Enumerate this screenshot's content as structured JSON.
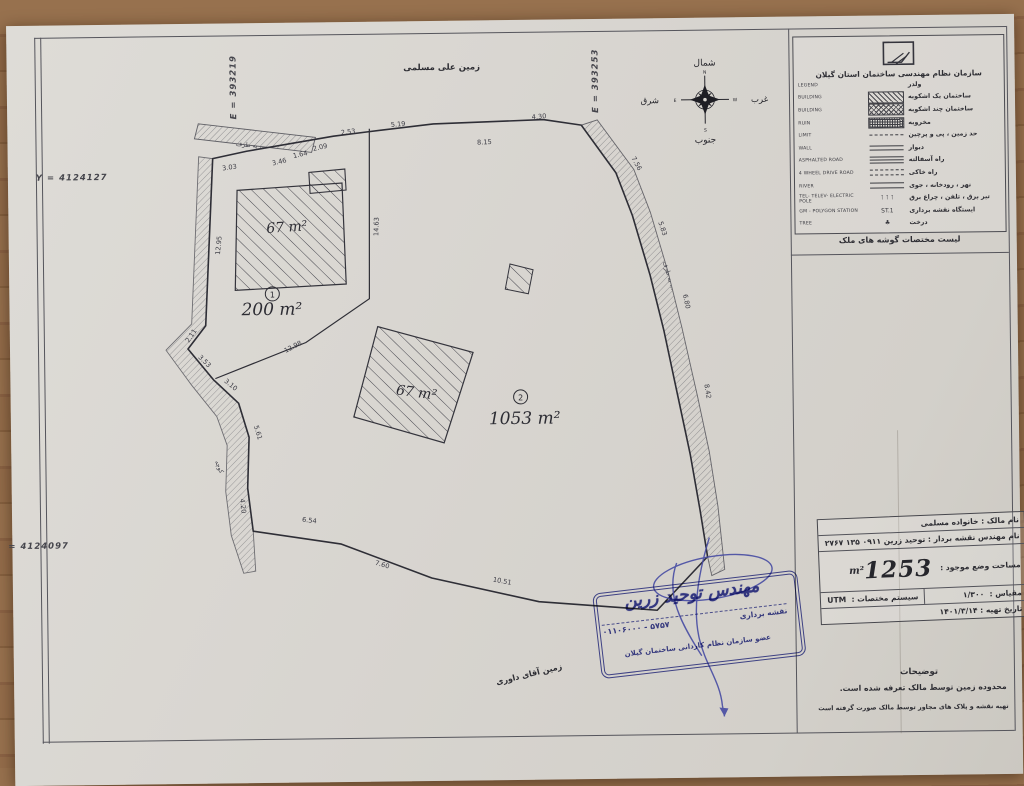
{
  "colors": {
    "paper": "#d8d5d0",
    "ink": "#3b3b44",
    "stamp_blue": "#41469d",
    "wood": "#8d6847"
  },
  "coordinates": {
    "y_top": "Y = 4124127",
    "y_bottom": "= 4124097",
    "e_left": "E = 393219",
    "e_right": "E = 393253"
  },
  "top_label": "زمین علی مسلمی",
  "bottom_left_label": "زمین آقای داوری",
  "compass": {
    "north_fa": "شمال",
    "south_fa": "جنوب",
    "east_fa": "شرق",
    "west_fa": "غرب",
    "n": "N",
    "s": "S",
    "e": "E",
    "w": "W"
  },
  "parcels": {
    "p1": {
      "number": "1",
      "area": "200",
      "area_unit": "m²",
      "building_area": "67",
      "building_unit": "m²"
    },
    "p2": {
      "number": "2",
      "area": "1053",
      "area_unit": "m²",
      "building_area": "67",
      "building_unit": "m²"
    }
  },
  "measurements": [
    {
      "v": "3.03",
      "x": 222,
      "y": 146,
      "r": -8
    },
    {
      "v": "3.46",
      "x": 272,
      "y": 141,
      "r": -12
    },
    {
      "v": "1.64",
      "x": 293,
      "y": 134,
      "r": -12
    },
    {
      "v": "2.09",
      "x": 313,
      "y": 127,
      "r": -12
    },
    {
      "v": "2.53",
      "x": 341,
      "y": 112,
      "r": -6
    },
    {
      "v": "5.19",
      "x": 391,
      "y": 105,
      "r": -4
    },
    {
      "v": "8.15",
      "x": 477,
      "y": 124,
      "r": -2
    },
    {
      "v": "4.30",
      "x": 532,
      "y": 99,
      "r": -4
    },
    {
      "v": "12.95",
      "x": 212,
      "y": 222,
      "r": -84
    },
    {
      "v": "14.63",
      "x": 370,
      "y": 205,
      "r": -88
    },
    {
      "v": "12.98",
      "x": 284,
      "y": 326,
      "r": -27
    },
    {
      "v": "2.11",
      "x": 183,
      "y": 313,
      "r": -55
    },
    {
      "v": "3.53",
      "x": 193,
      "y": 339,
      "r": 45
    },
    {
      "v": "3.10",
      "x": 219,
      "y": 363,
      "r": 40
    },
    {
      "v": "5.61",
      "x": 245,
      "y": 410,
      "r": 74
    },
    {
      "v": "4.20",
      "x": 229,
      "y": 483,
      "r": 84
    },
    {
      "v": "6.54",
      "x": 297,
      "y": 500,
      "r": 7
    },
    {
      "v": "7.60",
      "x": 369,
      "y": 545,
      "r": 16
    },
    {
      "v": "10.51",
      "x": 489,
      "y": 563,
      "r": 11
    },
    {
      "v": "7.56",
      "x": 627,
      "y": 146,
      "r": 62
    },
    {
      "v": "5.83",
      "x": 652,
      "y": 211,
      "r": 72
    },
    {
      "v": "6.80",
      "x": 675,
      "y": 284,
      "r": 78
    },
    {
      "v": "8.42",
      "x": 695,
      "y": 374,
      "r": 81
    }
  ],
  "road_labels": [
    {
      "t": "به طرف ...",
      "x": 243,
      "y": 124,
      "r": 6
    },
    {
      "t": "به طرف ...",
      "x": 658,
      "y": 258,
      "r": 74
    },
    {
      "t": "کوچه",
      "x": 206,
      "y": 444,
      "r": 68
    }
  ],
  "legend": {
    "org_name": "سازمان نظام مهندسی ساختمان استان گیلان",
    "footer": "لیست مختصات گوشه های ملک",
    "rows": [
      {
        "en": "LEGEND",
        "fa": "ولدر",
        "sym": "none"
      },
      {
        "en": "BUILDING",
        "fa": "ساختمان یک اشکوبه",
        "sym": "diagonal-hatch"
      },
      {
        "en": "BUILDING",
        "fa": "ساختمان چند اشکوبه",
        "sym": "cross-hatch"
      },
      {
        "en": "RUIN",
        "fa": "مخروبه",
        "sym": "dense-hatch"
      },
      {
        "en": "LIMIT",
        "fa": "حد زمین ، پی و پرچین",
        "sym": "dash-dot"
      },
      {
        "en": "WALL",
        "fa": "دیوار",
        "sym": "double-line"
      },
      {
        "en": "ASPHALTED ROAD",
        "fa": "راه آسفالته",
        "sym": "triple-line"
      },
      {
        "en": "4 WHEEL DRIVE ROAD",
        "fa": "راه خاکی",
        "sym": "dashed-lines"
      },
      {
        "en": "RIVER",
        "fa": "نهر ، رودخانه ، جوی",
        "sym": "river-lines"
      },
      {
        "en": "TEL- TELEV- ELECTRIC POLE",
        "fa": "تیر برق ، تلفن ، چراغ برق",
        "sym": "poles"
      },
      {
        "en": "GM - POLYGON STATION",
        "fa": "ایستگاه نقشه برداری",
        "sym": "station"
      },
      {
        "en": "TREE",
        "fa": "درخت",
        "sym": "tree"
      }
    ],
    "sym_glyphs": {
      "poles": "⊺ ⊺ ⊺",
      "station": "ST.1",
      "tree": "♣"
    }
  },
  "info_table": {
    "owner_label": "نام مالک :",
    "owner_value": "خانواده مسلمی",
    "engineer_label": "نام مهندس نقشه بردار :",
    "engineer_value": "توحید زرین ۰۹۱۱ ۱۳۵ ۲۷۶۷",
    "area_label": "مساحت وضع موجود :",
    "area_value": "1253",
    "area_unit": "m²",
    "scale_label": "مقیاس :",
    "scale_value": "۱/۳۰۰",
    "coordsys_label": "سیستم مختصات :",
    "coordsys_value": "UTM",
    "date_label": "تاریخ تهیه :",
    "date_value": "۱۴۰۱/۳/۱۴"
  },
  "notes": {
    "title": "توضیحات",
    "lines": [
      "محدوده زمین توسط مالک تعرفه شده است.",
      "تهیه نقشه و پلاک های مجاور توسط مالک صورت گرفته است"
    ]
  },
  "stamp": {
    "name": "مهندس توحید زرین",
    "job": "نقشه برداری",
    "phone": "۰۱۱۰۶۰۰۰ - ۵۷۵۷",
    "member": "عضو سازمان نظام کاردانی ساختمان گیلان"
  }
}
